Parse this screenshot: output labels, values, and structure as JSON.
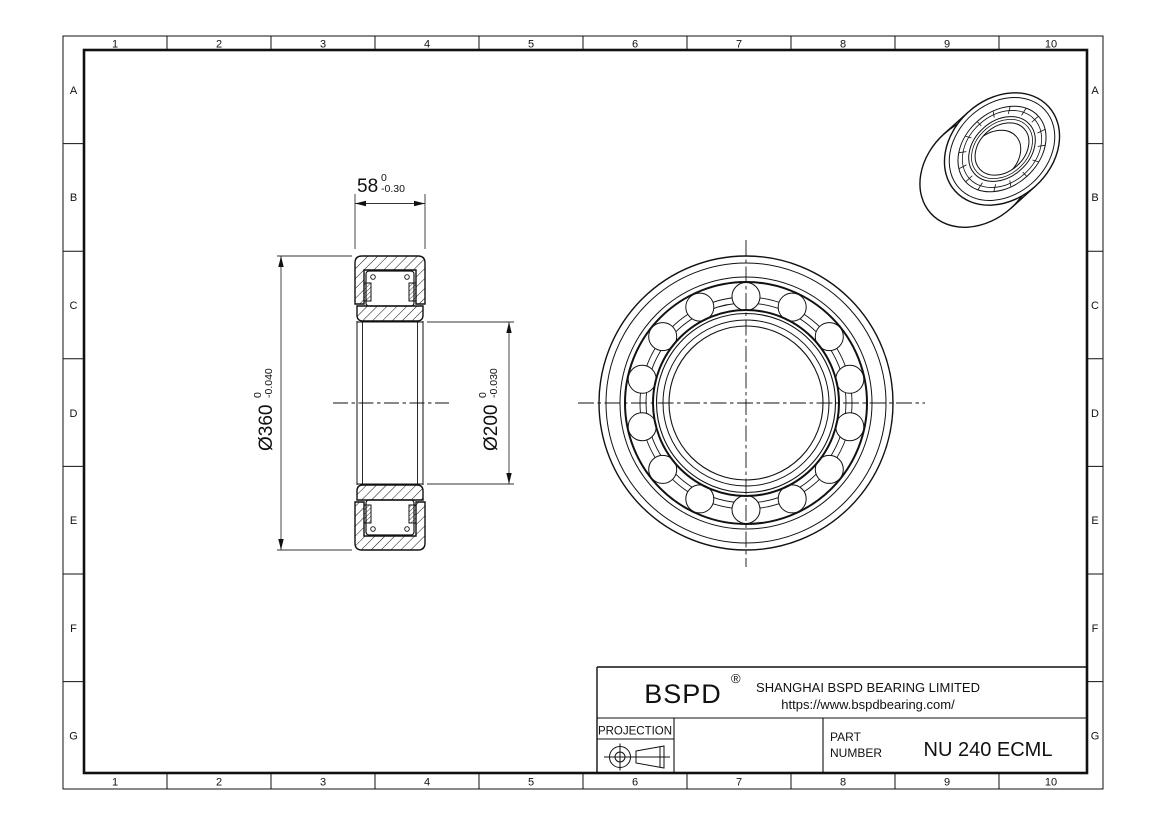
{
  "sheet": {
    "background": "#ffffff",
    "line_color": "#111111"
  },
  "grid": {
    "columns": [
      "1",
      "2",
      "3",
      "4",
      "5",
      "6",
      "7",
      "8",
      "9",
      "10"
    ],
    "rows": [
      "A",
      "B",
      "C",
      "D",
      "E",
      "F",
      "G"
    ]
  },
  "dimensions": {
    "width": {
      "value": "58",
      "tol_upper": "0",
      "tol_lower": "-0.30"
    },
    "outer_diameter": {
      "value": "Ø360",
      "tol_upper": "0",
      "tol_lower": "-0.040"
    },
    "bore_diameter": {
      "value": "Ø200",
      "tol_upper": "0",
      "tol_lower": "-0.030"
    }
  },
  "title_block": {
    "brand": "BSPD",
    "registered_mark": "®",
    "company": "SHANGHAI BSPD BEARING LIMITED",
    "website": "https://www.bspdbearing.com/",
    "projection_label": "PROJECTION",
    "part_label_line1": "PART",
    "part_label_line2": "NUMBER",
    "part_number": "NU 240 ECML"
  }
}
